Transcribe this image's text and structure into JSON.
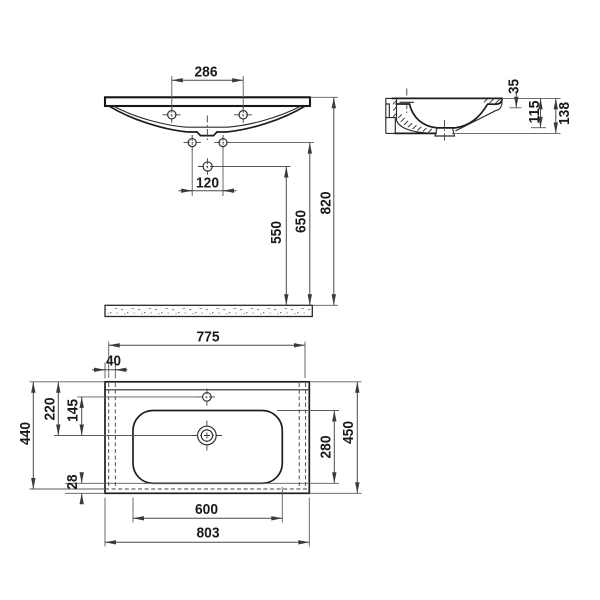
{
  "document": {
    "type": "sanitary-ware technical drawing",
    "subject": "wall-hung washbasin, three orthographic views with dimensions",
    "background_color": "#ffffff",
    "line_color": "#1e1e1e",
    "dimension_color": "#4a4a4a"
  },
  "views": {
    "front": {
      "dims": {
        "deck_hole_spacing": "286",
        "fixing_hole_spacing": "120",
        "drain_height": "550",
        "fixing_height": "650",
        "rim_height": "820"
      }
    },
    "side": {
      "dims": {
        "rim_to_ledge": "35",
        "bowl_inner_height": "115",
        "overall_height": "138"
      }
    },
    "plan": {
      "dims": {
        "underside_width": "775",
        "side_offset": "40",
        "rear_to_drain": "220",
        "tap_to_drain": "145",
        "underside_depth": "440",
        "front_lip": "28",
        "bowl_inner_depth": "280",
        "overall_depth": "450",
        "bowl_inner_width": "600",
        "overall_width": "803"
      }
    }
  }
}
